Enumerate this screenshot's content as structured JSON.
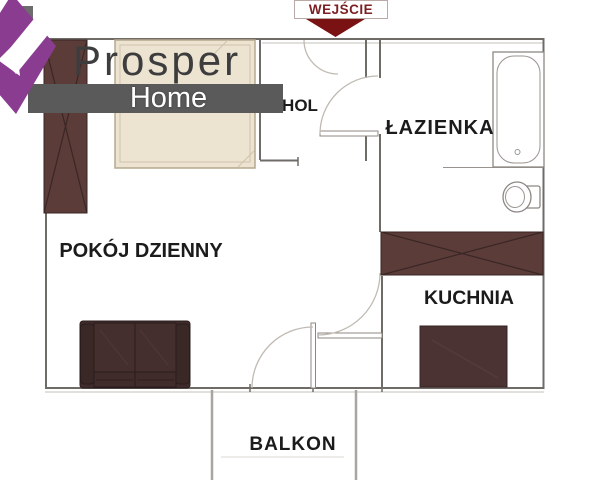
{
  "branding": {
    "title": "Prosper",
    "subtitle": "Home"
  },
  "entrance": {
    "label": "WEJŚCIE"
  },
  "rooms": {
    "hol": {
      "label": "HOL"
    },
    "lazienka": {
      "label": "ŁAZIENKA"
    },
    "pokoj_dzienny": {
      "label": "POKÓJ DZIENNY"
    },
    "kuchnia": {
      "label": "KUCHNIA"
    },
    "balkon": {
      "label": "BALKON"
    }
  },
  "furniture": [
    "bed",
    "wardrobe",
    "sofa",
    "bathtub",
    "toilet",
    "kitchen-counter",
    "kitchen-table"
  ],
  "colors": {
    "wall": "#6f6b67",
    "wall-light": "#c6c1bb",
    "arc": "#c0bab3",
    "label": "#1b1b1b",
    "entry": "#7a1113",
    "entry-text": "#7b1f22",
    "entry-border": "#bba9a5",
    "purple": "#8a3c90",
    "chimney": "#6d6d6d",
    "banner": "#5a5a5a",
    "brand": "#3d3d3d",
    "bed-fill": "#ece3d1",
    "bed-border": "#b5a88e",
    "bed-inner": "#cfc3ab",
    "wood": "#5b3c39",
    "wood-line": "#392625",
    "table": "#4b3334",
    "table-line": "#362322",
    "table-sheen": "#553b39",
    "sofa-base": "#3f2b2a",
    "sofa-arm": "#3a2827",
    "sofa-cushion": "#452f2e",
    "sofa-seat": "#402c2b",
    "sofa-line": "#2a1c1c",
    "sofa-sheen": "#523938",
    "fixture": "#8d8783",
    "fixture-light": "#9a948f",
    "balcony-wall": "#a9a49f",
    "rail": "#dcd8d3"
  }
}
